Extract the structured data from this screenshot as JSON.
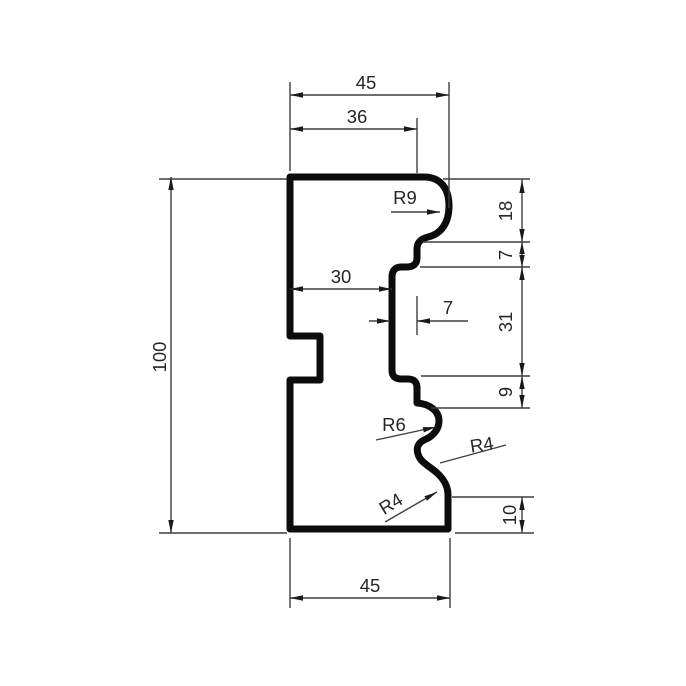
{
  "drawing": {
    "description": "Dimensioned technical drawing of a moulding profile cross-section",
    "colors": {
      "background": "#ffffff",
      "profile_outline": "#0c0c0c",
      "dimension_lines": "#3f3f3f",
      "text": "#262626"
    },
    "dimensions": {
      "top_width": {
        "label": "45",
        "value": 45,
        "orientation": "horizontal"
      },
      "top_flat": {
        "label": "36",
        "value": 36,
        "orientation": "horizontal"
      },
      "overall_height": {
        "label": "100",
        "value": 100,
        "orientation": "vertical"
      },
      "recess_offset": {
        "label": "30",
        "value": 30,
        "orientation": "horizontal"
      },
      "recess_depth": {
        "label": "7",
        "value": 7,
        "orientation": "horizontal"
      },
      "right_nose": {
        "label": "18",
        "value": 18,
        "orientation": "vertical"
      },
      "right_step": {
        "label": "7",
        "value": 7,
        "orientation": "vertical"
      },
      "right_recess": {
        "label": "31",
        "value": 31,
        "orientation": "vertical"
      },
      "right_below": {
        "label": "9",
        "value": 9,
        "orientation": "vertical"
      },
      "bottom_lip": {
        "label": "10",
        "value": 10,
        "orientation": "vertical"
      },
      "bottom_width": {
        "label": "45",
        "value": 45,
        "orientation": "horizontal"
      }
    },
    "radii": {
      "nose": {
        "label": "R9",
        "value": 9
      },
      "ogee_top": {
        "label": "R6",
        "value": 6
      },
      "ogee_middle": {
        "label": "R4",
        "value": 4
      },
      "ogee_bottom": {
        "label": "R4",
        "value": 4
      }
    }
  }
}
